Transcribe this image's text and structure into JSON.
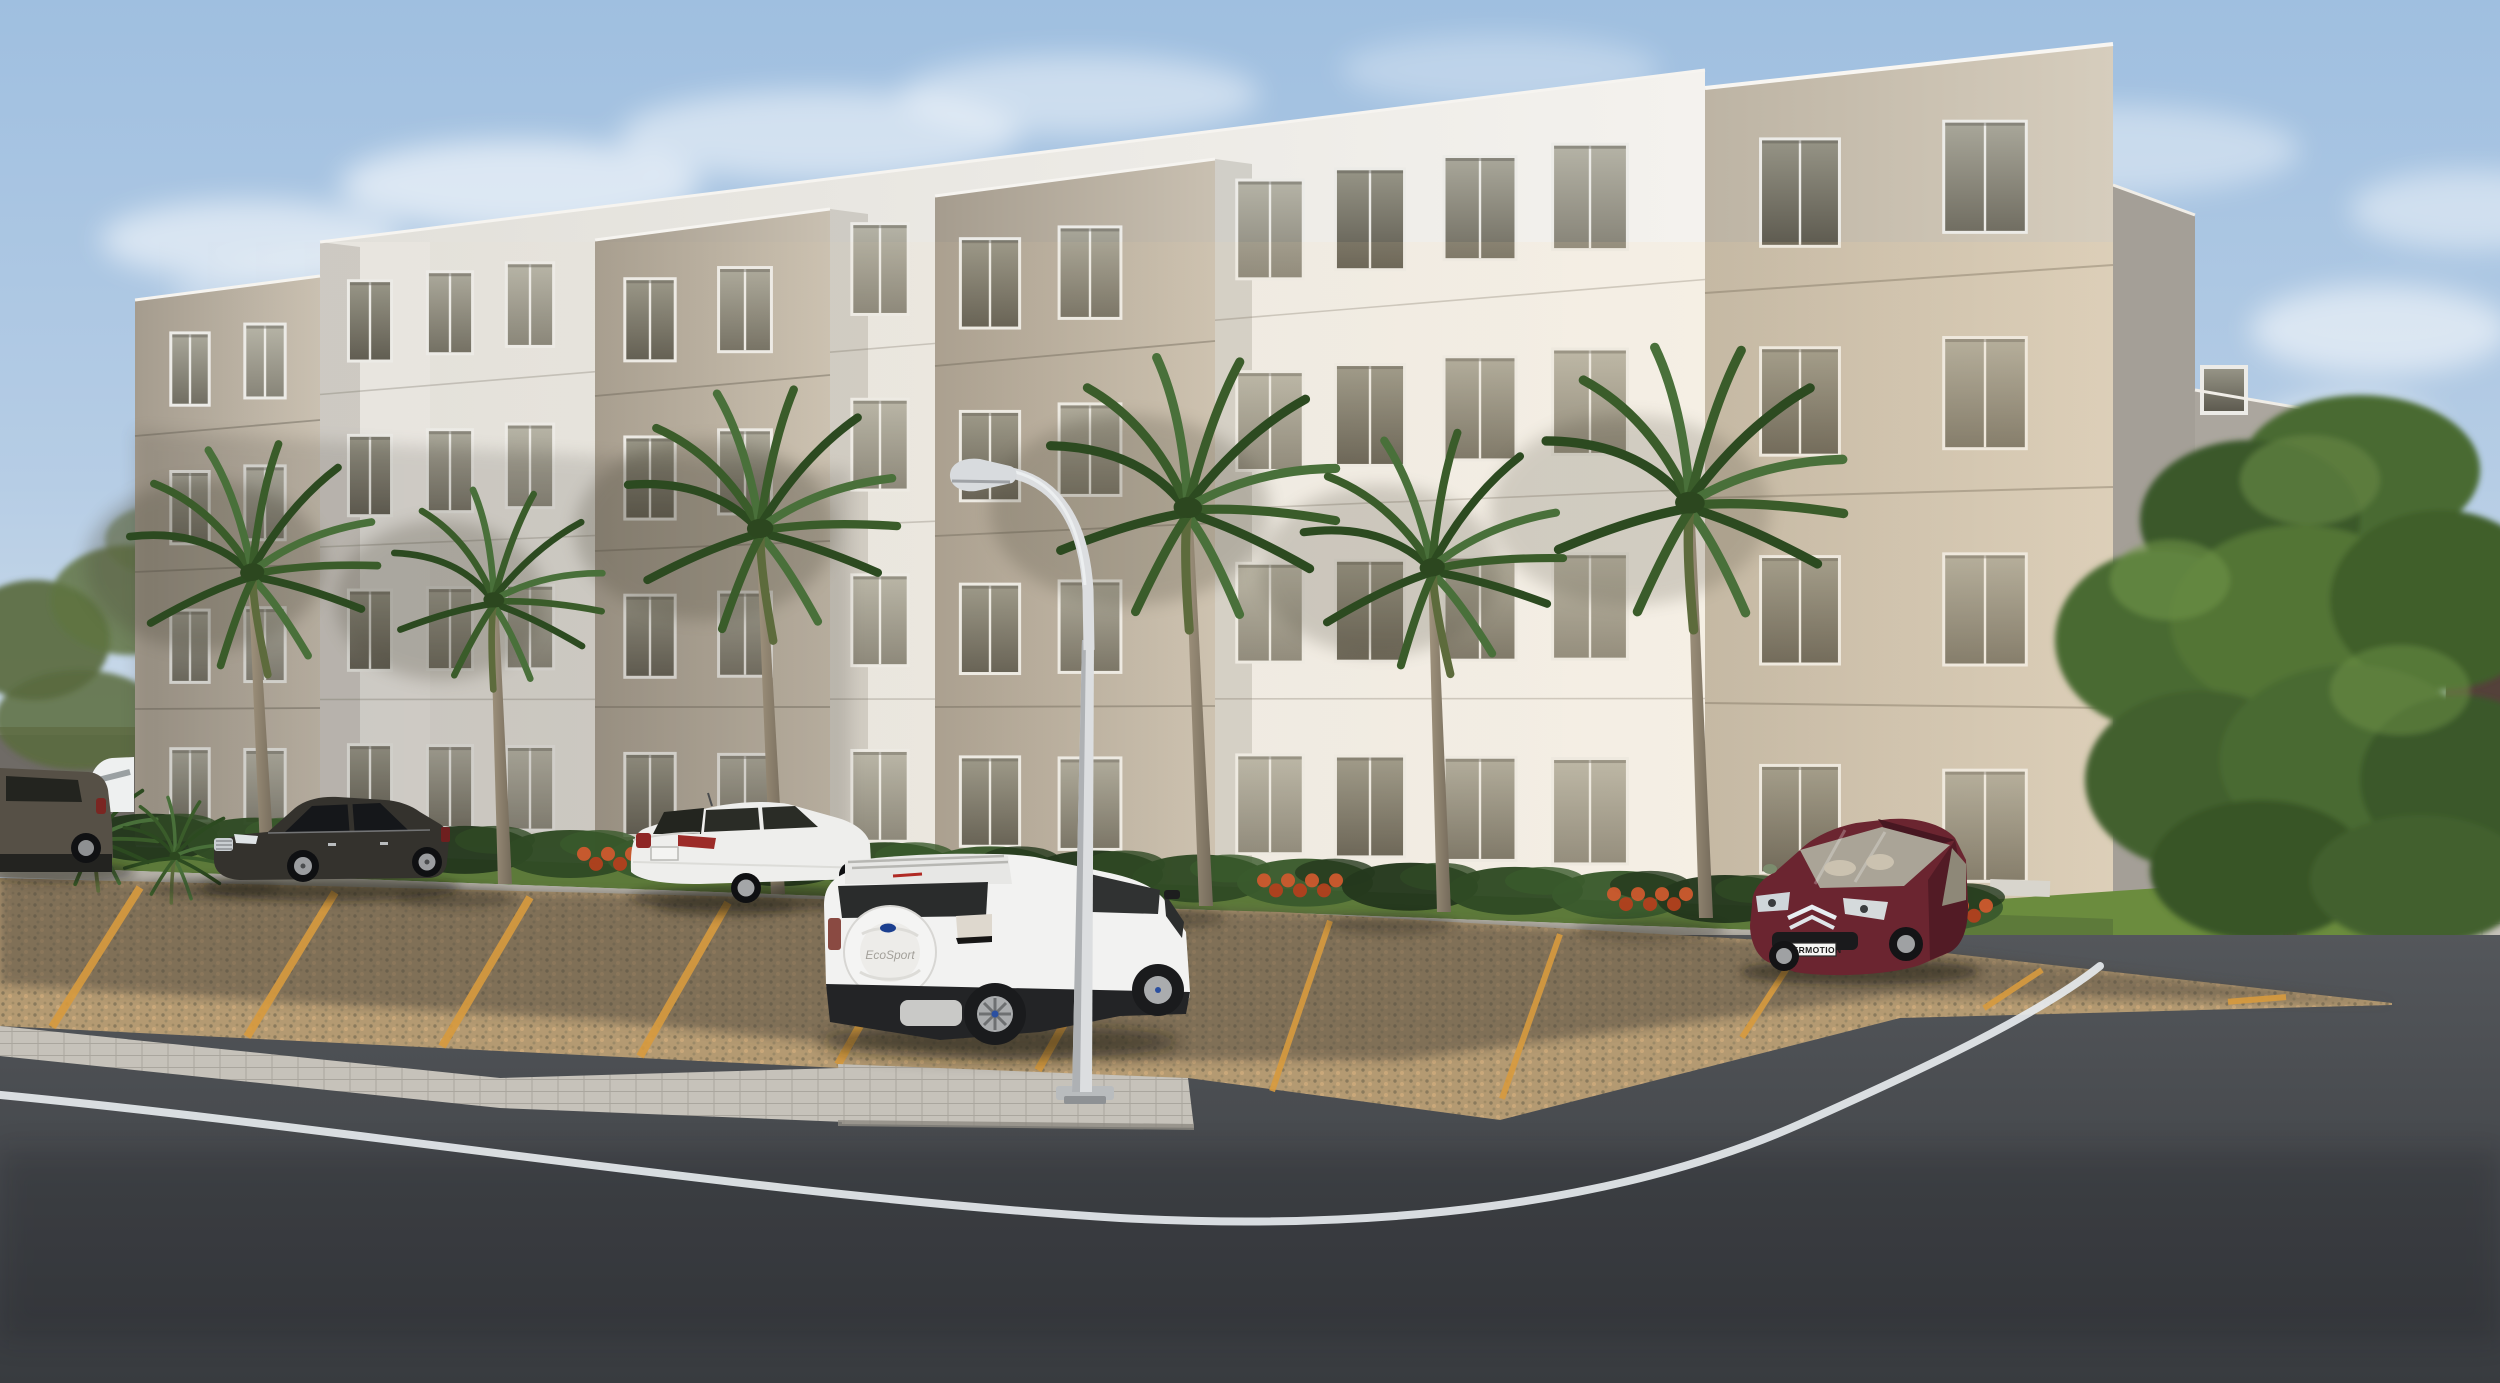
{
  "scene": {
    "description": "Dusk 3D architectural rendering of a four-storey apartment complex with palm trees, paved parking bays and a curving asphalt street",
    "building": {
      "floors": 4,
      "blocks": "alternating tan and white flat-roof volumes"
    },
    "labels": {
      "suv_spare_cover_badge": "EcoSport",
      "maroon_car_license_plate": "EVERMOTION"
    },
    "counts": {
      "palm_trees": 6,
      "cars_visible": 5,
      "street_lamps": 1
    },
    "palette": {
      "sky_top": "#9fbfe0",
      "sky_horizon": "#f3efe6",
      "facade_tan": "#b5ab9d",
      "facade_tan_lit": "#cbc2b2",
      "facade_white": "#f0eeea",
      "window_glass": "#8f8d80",
      "window_frame": "#ecebe7",
      "grass": "#5d7a3a",
      "lawn": "#6b8c3e",
      "shrub": "#2f4a24",
      "flower_red": "#c04923",
      "palm_frond": "#3a5c2a",
      "palm_trunk": "#8d8272",
      "gravel": "#b49a72",
      "parking_line": "#d89b3e",
      "paver": "#c6c2ba",
      "asphalt": "#474a4e",
      "road_line_white": "#e6eaee",
      "lamp_metal": "#d8dbde",
      "wall_gray": "#6f6b66",
      "car_dark": "#2e2c29",
      "car_white": "#f0f0ee",
      "car_maroon": "#6b2530",
      "tree_green": "#4a6b33"
    }
  }
}
